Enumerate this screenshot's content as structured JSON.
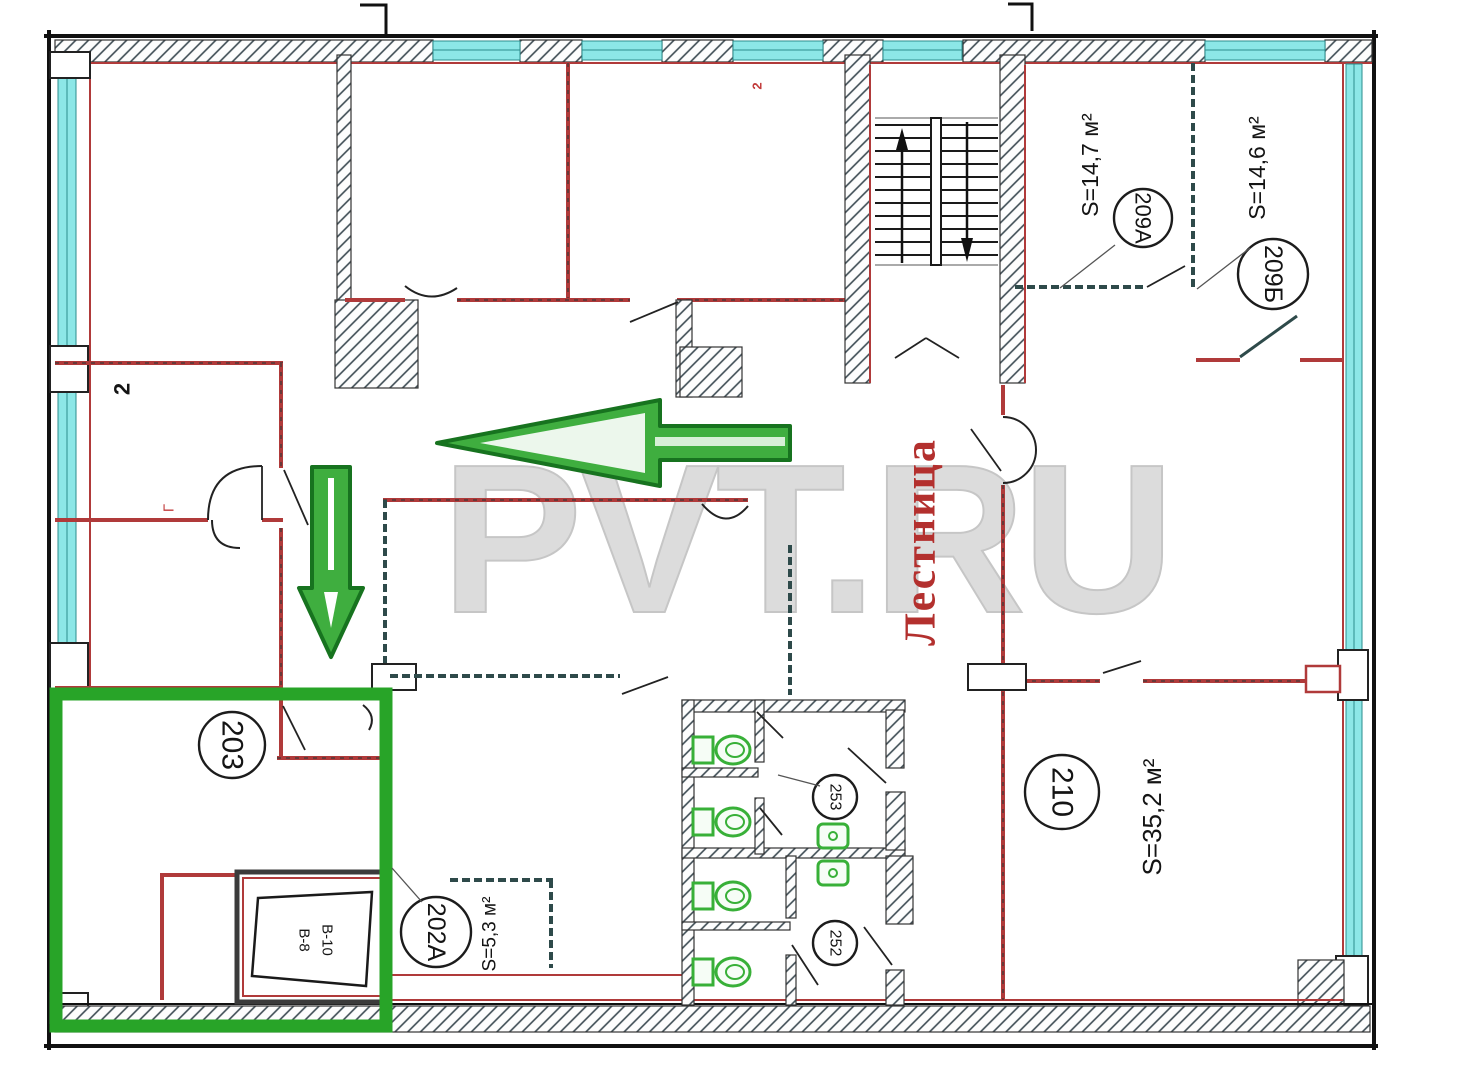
{
  "watermark": "PVT.RU",
  "staircase": {
    "label": "Лестница"
  },
  "rooms": {
    "r203": {
      "number": "203"
    },
    "r202a": {
      "number": "202A",
      "area": "S=5,3 м²"
    },
    "r209a": {
      "number": "209A",
      "area": "S=14,7 м²"
    },
    "r209b": {
      "number": "209Б",
      "area": "S=14,6 м²"
    },
    "r210": {
      "number": "210",
      "area": "S=35,2 м²"
    },
    "r253": {
      "number": "253"
    },
    "r252": {
      "number": "252"
    }
  },
  "vent": {
    "label1": "В-8",
    "label2": "В-10"
  },
  "marks": {
    "left_room": "2",
    "left_door": "Г",
    "top_room": "2"
  },
  "colors": {
    "wall": "#b03a3a",
    "window": "#8ce7e7",
    "highlight_green": "#28a428",
    "staircase_text": "#b3302e",
    "watermark": "#dcdcdc"
  }
}
